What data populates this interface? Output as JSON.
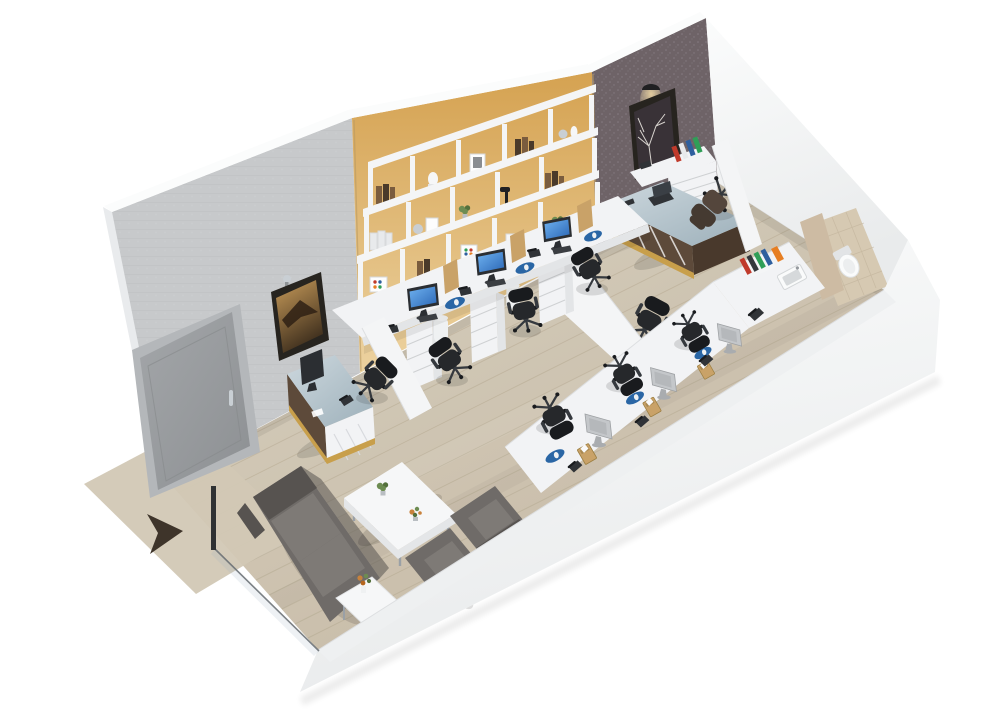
{
  "meta": {
    "title": "3D Office Floor Plan Render",
    "view": "isometric-3d-cutaway",
    "canvas": {
      "width": 992,
      "height": 727
    }
  },
  "colors": {
    "bg": "#ffffff",
    "wall_top": "#fbfcfc",
    "wall_edge": "#e0e2e4",
    "wall_gray": "#c7c9cb",
    "wall_gray_line": "#bdbfc1",
    "wall_yellow": "#d5a251",
    "wall_yellow_light": "#ecd2a0",
    "wall_boundary": "#b99a62",
    "wall_dark": "#6e6367",
    "wall_dark_speck": "#857b81",
    "wall_white": "#f5f6f7",
    "wall_white_shade": "#e9ebec",
    "outer_face": "#e9ebed",
    "floor_light": "#d8cfbd",
    "floor_dark": "#c2b6a1",
    "plank": "#b0a48c",
    "mat": "#dbd2be",
    "arrow": "#3e342a",
    "door": "#a3a6a9",
    "door_dark": "#8d9093",
    "door_frame": "#b4b7ba",
    "chrome": "#c9cfd4",
    "desk": "#f2f3f5",
    "desk_shade": "#e3e5e7",
    "drawer_line": "#cfd1d3",
    "partition": "#f4f5f6",
    "partition_edge": "#dddfe1",
    "chair": "#26282b",
    "chair_dark": "#191b1e",
    "chair_mid": "#35393e",
    "mgr_chair": "#54463c",
    "mgr_chair_dark": "#453a31",
    "sofa": "#6f6b68",
    "sofa_dark": "#575350",
    "sofa_cushion": "#7e7a76",
    "table": "#f6f7f8",
    "table_edge": "#e4e6e8",
    "wood": "#5d4a3a",
    "wood_dark": "#49392c",
    "gold": "#c89f4b",
    "glass_a": "#cdd8de",
    "glass_b": "#9db0ba",
    "screen_a": "#6fb2f0",
    "screen_b": "#2b67b6",
    "mon_frame": "#2b2e32",
    "mon_back": "#c4c7ca",
    "mon_back2": "#a9acaf",
    "pad": "#2a66a5",
    "mouse": "#eef1f3",
    "binder_red": "#c03a2b",
    "binder_blue": "#2e5f9e",
    "binder_green": "#2f9e57",
    "binder_orange": "#e67e22",
    "binder_dark": "#34383c",
    "binder_white": "#e8eaec",
    "box_tan": "#c9a268",
    "box_tan_dark": "#9c7f42",
    "tile": "#d6c9b2",
    "tile_line": "#bfb199",
    "tan_wall": "#cdbba3",
    "fixture": "#fafbfb",
    "fixture_shade": "#e2e4e6",
    "basin": "#d6d9db",
    "art_frame": "#27241f",
    "sepia_a": "#c99c5a",
    "sepia_b": "#40301e",
    "art_dark": "#393237",
    "branch": "#eae6e0",
    "lamp": "#202022",
    "glow": "#f7dfa8",
    "green_a": "#6d8c52",
    "green_b": "#53703c",
    "pot": "#b9bec2",
    "flower": "#c8823c",
    "shadow": "#000000",
    "book_a": "#7a5c3e",
    "book_b": "#4a3a2a",
    "phone_c": "#303337",
    "kbd_c": "#3b3e42",
    "cpu_white": "#eff1f2",
    "glass_line": "#676d72"
  },
  "scene": {
    "type": "office-floorplan-3d-render",
    "rooms": [
      {
        "name": "open-office-area",
        "workstations_back_wall": 3,
        "workstations_front_wall": 3,
        "features": [
          "yellow-accent-wall",
          "wall-shelving-unit",
          "wood-plank-floor"
        ]
      },
      {
        "name": "manager-office",
        "items": [
          "l-shaped-executive-desk",
          "executive-chair",
          "guest-chair",
          "side-desk-with-drawers",
          "binder-shelf",
          "framed-tree-art",
          "wall-lamp"
        ],
        "features": [
          "dark-textured-accent-wall",
          "white-partition-wall"
        ]
      },
      {
        "name": "bathroom",
        "items": [
          "toilet",
          "sink-basin"
        ],
        "features": [
          "beige-tile-floor"
        ]
      },
      {
        "name": "lounge",
        "items": [
          "two-seat-sofa",
          "armchair",
          "armchair",
          "coffee-table-with-plants",
          "side-table-with-flowers"
        ]
      },
      {
        "name": "reception",
        "items": [
          "reception-desk-glass-top",
          "monitor",
          "desk-phone",
          "office-chair",
          "framed-picture",
          "wall-lamp"
        ]
      },
      {
        "name": "entrance",
        "items": [
          "entry-mat",
          "direction-arrow",
          "glass-partition-post",
          "gray-door"
        ]
      },
      {
        "name": "corridor",
        "items": [
          "counter",
          "binder-row",
          "desk-phone"
        ]
      }
    ],
    "desk_accessories": [
      "monitor",
      "keyboard",
      "desk-phone",
      "blue-mouse-pad",
      "wooden-organizer-box",
      "cpu-tower"
    ],
    "binder_colors_visible": [
      "red",
      "dark-blue",
      "green",
      "black",
      "orange",
      "white"
    ]
  }
}
